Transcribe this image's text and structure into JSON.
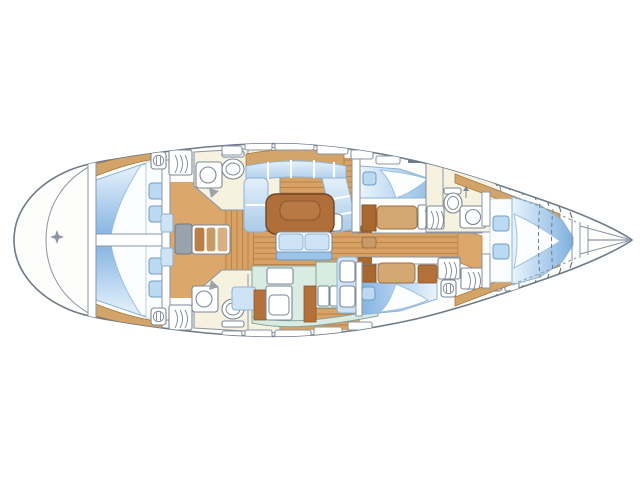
{
  "diagram": {
    "type": "sailing-yacht-interior-layout-plan",
    "view": "top-down",
    "orientation": {
      "bow": "right",
      "stern": "left",
      "port": "top",
      "starboard": "bottom"
    }
  },
  "colors": {
    "hull_stroke": "#6e7b88",
    "deck_white": "#fdfdfc",
    "wall_gray": "#8a96a4",
    "floor_wood": "#d8a265",
    "floor_seam": "#b9834a",
    "vestibule_wood": "#dba76b",
    "table_wood": "#b06f3a",
    "berth_blue_light": "#e9f4fd",
    "berth_blue": "#7fb0e0",
    "pillow_blue": "#bcd9f2",
    "cushion_blue": "#cfe3f6",
    "galley_mint": "#d9ece3",
    "head_cream": "#f7f2df",
    "cabinet_brown": "#b5713a",
    "dresser_tan": "#d3a873",
    "step_tan": "#c89a66",
    "engine_gray": "#9aa3ac",
    "rail_blue": "#9cc4e8"
  },
  "compartments": {
    "stern_platform": {
      "label": "Stern platform with transom arc and deck fitting marker"
    },
    "aft_cabin_port": {
      "label": "Aft double cabin (port) with berth and two pillows"
    },
    "aft_cabin_starboard": {
      "label": "Aft double cabin (starboard) with berth and two pillows"
    },
    "aft_head_port": {
      "label": "Aft head (port) with washbasin, toilet and shower"
    },
    "aft_head_starboard": {
      "label": "Aft head (starboard) with washbasin, toilet and shower"
    },
    "companionway": {
      "label": "Companionway steps with engine box"
    },
    "saloon": {
      "label": "Saloon with U-settee, dining table, bench seat and stool"
    },
    "galley": {
      "label": "Galley with stove, cabinets, twin sinks and refrigerator"
    },
    "mid_cabin_port": {
      "label": "Guest cabin (port) with berth, dresser and louvered locker"
    },
    "mid_cabin_starboard": {
      "label": "Guest cabin (starboard) with berth and dressers"
    },
    "forward_head": {
      "label": "Forward head with toilet, washbasin and louvered locker"
    },
    "storage_lockers": {
      "label": "Storage lockers (starboard aft of bow cabin)"
    },
    "owners_cabin": {
      "label": "Bow owner's cabin with V-berth, pillows, side shelves and deck hatch"
    },
    "forepeak": {
      "label": "Forepeak / anchor locker"
    }
  },
  "fixture_counts": {
    "cabins": 5,
    "heads": 3,
    "berths": 5,
    "pillows": 8,
    "toilets": 3,
    "sinks": 4
  }
}
